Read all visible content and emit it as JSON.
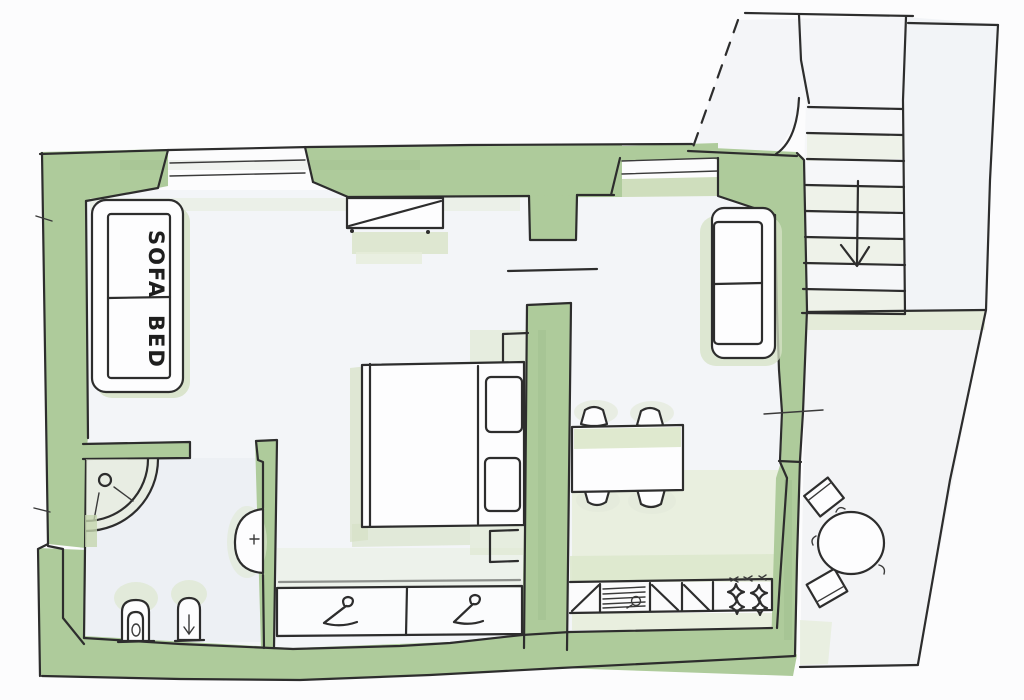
{
  "title": "Hand-drawn apartment floor plan with terrace and staircase",
  "labels": {
    "sofa": "SOFA",
    "bed": "BED"
  },
  "palette": {
    "wall_green": "#aecb9b",
    "wall_green_dark": "#9db989",
    "wash_green": "#dde7cc",
    "wash_green_pale": "#e9efdf",
    "ink": "#2d2d2d",
    "floor_grey": "#f3f5f8",
    "bathroom_floor": "#edf0f4",
    "paper": "#fcfcfd"
  },
  "rooms": [
    {
      "name": "living-room",
      "furniture": [
        "sofa-bed",
        "radiator-under-window",
        "window"
      ]
    },
    {
      "name": "sleeping-area",
      "furniture": [
        "double-bed",
        "two-pillows",
        "nightstands"
      ]
    },
    {
      "name": "bathroom",
      "furniture": [
        "corner-shower",
        "washbasin",
        "toilet",
        "bidet"
      ]
    },
    {
      "name": "hallway",
      "furniture": [
        "wardrobe-two-sections-with-hangers"
      ]
    },
    {
      "name": "kitchen-dining",
      "furniture": [
        "kitchen-counter",
        "sink",
        "four-burner-stove",
        "dining-table",
        "four-chairs",
        "two-seat-sofa"
      ]
    },
    {
      "name": "terrace",
      "furniture": [
        "round-table",
        "two-chairs"
      ]
    },
    {
      "name": "staircase",
      "furniture": [
        "nine-steps",
        "down-direction-arrow",
        "dashed-boundary-line"
      ]
    }
  ]
}
